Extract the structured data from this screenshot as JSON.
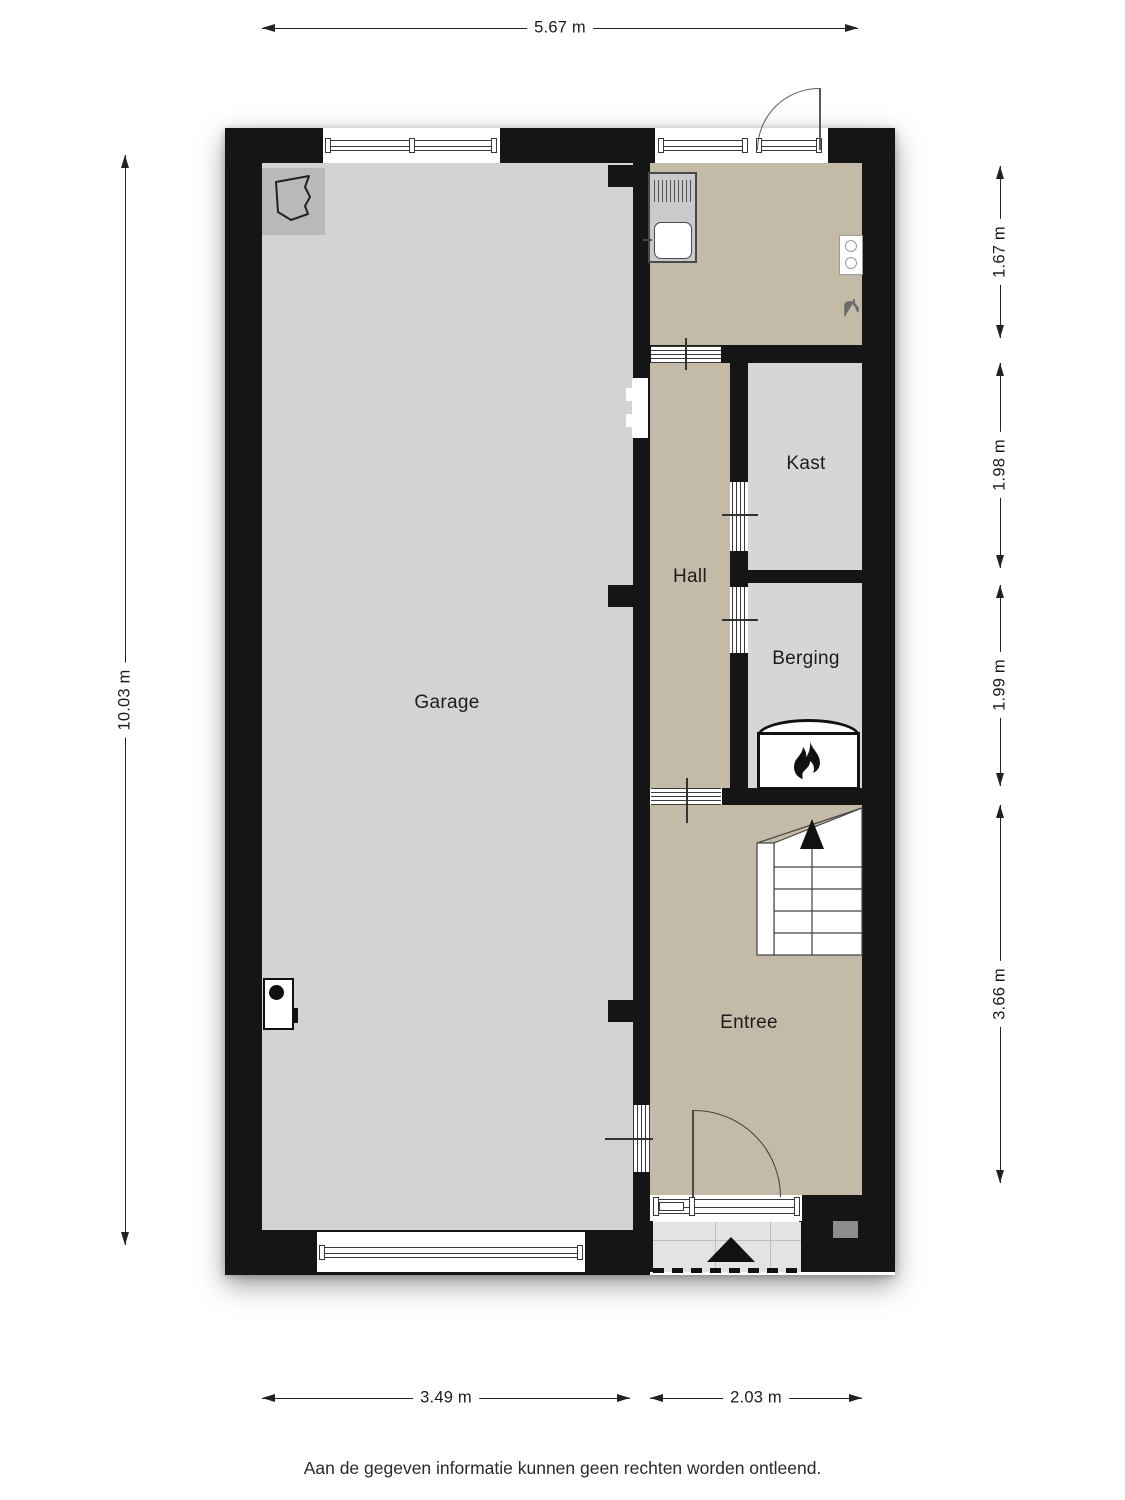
{
  "dimensions": {
    "top": "5.67 m",
    "left": "10.03 m",
    "right": [
      "1.67 m",
      "1.98 m",
      "1.99 m",
      "3.66 m"
    ],
    "bottom": [
      "3.49 m",
      "2.03 m"
    ]
  },
  "rooms": {
    "garage": "Garage",
    "hall": "Hall",
    "kast": "Kast",
    "berging": "Berging",
    "entree": "Entree"
  },
  "footer": {
    "disclaimer": "Aan de gegeven informatie kunnen geen rechten worden ontleend."
  },
  "colors": {
    "wall": "#151515",
    "garage_floor": "#d3d3d3",
    "storage_floor": "#d6d6d6",
    "hall_floor": "#c4baa8",
    "porch": "#e3e3e3"
  },
  "icons": {
    "flame": "fireplace-flame",
    "stairs_arrow": "stairs-up-arrow",
    "entrance_marker": "entrance-triangle",
    "sink": "utility-sink",
    "boiler": "wall-boiler",
    "tap": "water-tap"
  }
}
